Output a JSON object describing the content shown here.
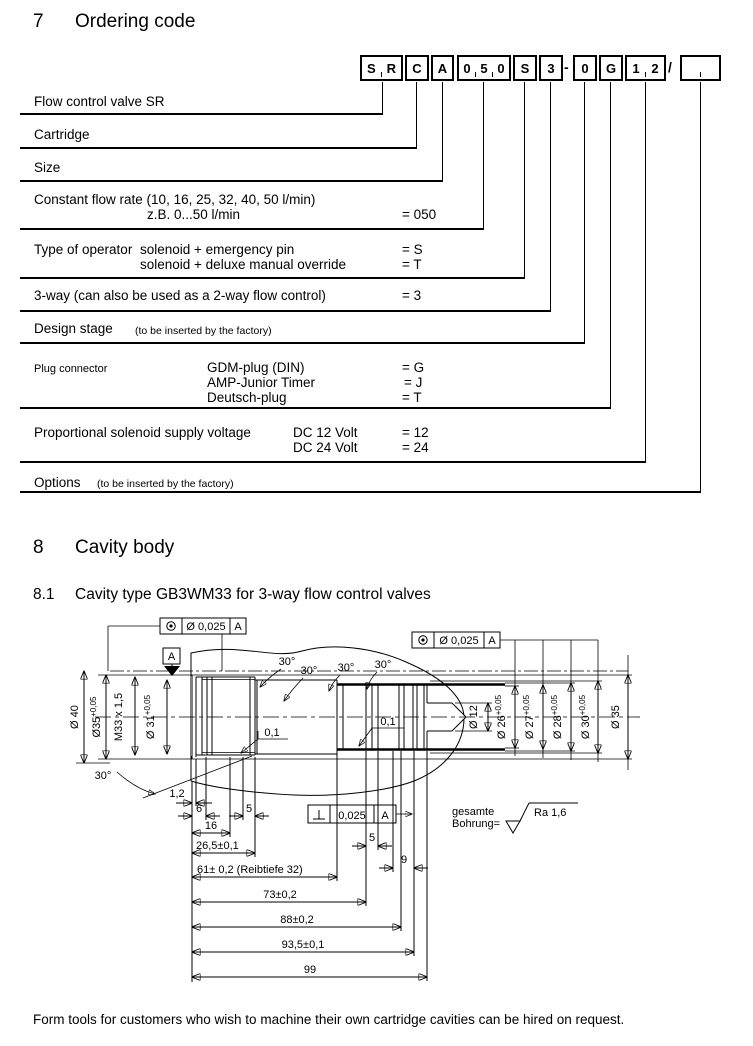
{
  "page": {
    "section7": {
      "number": "7",
      "title": "Ordering code"
    },
    "section8": {
      "number": "8",
      "title": "Cavity body"
    },
    "section81": {
      "number": "8.1",
      "title": "Cavity type GB3WM33 for 3-way flow control valves"
    },
    "footer_note": "Form tools for customers who wish to machine their own cartridge cavities can be hired on request."
  },
  "ordering": {
    "boxes": [
      {
        "chars": [
          "S",
          "R"
        ]
      },
      {
        "chars": [
          "C"
        ]
      },
      {
        "chars": [
          "A"
        ]
      },
      {
        "chars": [
          "0",
          "5",
          "0"
        ]
      },
      {
        "chars": [
          "S"
        ]
      },
      {
        "chars": [
          "3"
        ]
      },
      {
        "chars": [
          "0"
        ]
      },
      {
        "chars": [
          "G"
        ]
      },
      {
        "chars": [
          "1",
          "2"
        ]
      },
      {
        "chars": []
      }
    ],
    "separators": {
      "dash": "-",
      "slash": "/"
    },
    "rows": [
      {
        "label": "Flow control valve SR"
      },
      {
        "label": "Cartridge"
      },
      {
        "label": "Size"
      },
      {
        "label": "Constant flow rate (10, 16, 25, 32, 40, 50 l/min)",
        "sub": [
          {
            "option": "z.B. 0...50 l/min",
            "value": "= 050"
          }
        ]
      },
      {
        "label": "Type of operator",
        "sub": [
          {
            "option": "solenoid + emergency pin",
            "value": "= S"
          },
          {
            "option": "solenoid + deluxe manual override",
            "value": "= T"
          }
        ]
      },
      {
        "label": "3-way  (can also be used as a 2-way flow control)",
        "value": "= 3"
      },
      {
        "label": "Design stage",
        "note": "(to be inserted by the factory)"
      },
      {
        "label": "Plug connector",
        "sub": [
          {
            "option": "GDM-plug (DIN)",
            "value": "= G"
          },
          {
            "option": "AMP-Junior Timer",
            "value": "= J"
          },
          {
            "option": "Deutsch-plug",
            "value": "= T"
          }
        ]
      },
      {
        "label": "Proportional solenoid supply voltage",
        "sub": [
          {
            "option": "DC 12 Volt",
            "value": "= 12"
          },
          {
            "option": "DC 24 Volt",
            "value": "= 24"
          }
        ]
      },
      {
        "label": "Options",
        "note": "(to be inserted by the factory)"
      }
    ]
  },
  "drawing": {
    "frames": [
      {
        "value": "Ø 0,025",
        "datum": "A"
      },
      {
        "value": "Ø 0,025",
        "datum": "A"
      },
      {
        "value": "0,025",
        "datum": "A"
      }
    ],
    "datum_label": "A",
    "left_dims": [
      {
        "text": "Ø 40",
        "sup": ""
      },
      {
        "text": "Ø35",
        "sup": "+0,05"
      },
      {
        "text": "M33 x 1,5",
        "sup": ""
      },
      {
        "text": "Ø 31",
        "sup": "+0,05"
      }
    ],
    "right_dims": [
      {
        "text": "Ø 12",
        "sup": ""
      },
      {
        "text": "Ø 26",
        "sup": "+0,05"
      },
      {
        "text": "Ø 27",
        "sup": "+0,05"
      },
      {
        "text": "Ø 28",
        "sup": "+0,05"
      },
      {
        "text": "Ø 30",
        "sup": "+0,05"
      },
      {
        "text": "Ø 35",
        "sup": ""
      }
    ],
    "angle_labels": [
      "30°",
      "30°",
      "30°",
      "30°",
      "30°"
    ],
    "tol01": [
      "0,1",
      "0,1"
    ],
    "length_dims": [
      "1,2",
      "6",
      "5",
      "16",
      "26,5±0,1",
      "5",
      "9",
      "61± 0,2 (Reibtiefe 32)",
      "73±0,2",
      "88±0,2",
      "93,5±0,1",
      "99"
    ],
    "surface_note": {
      "line1": "gesamte",
      "line2": "Bohrung=",
      "value": "Ra 1,6"
    }
  }
}
